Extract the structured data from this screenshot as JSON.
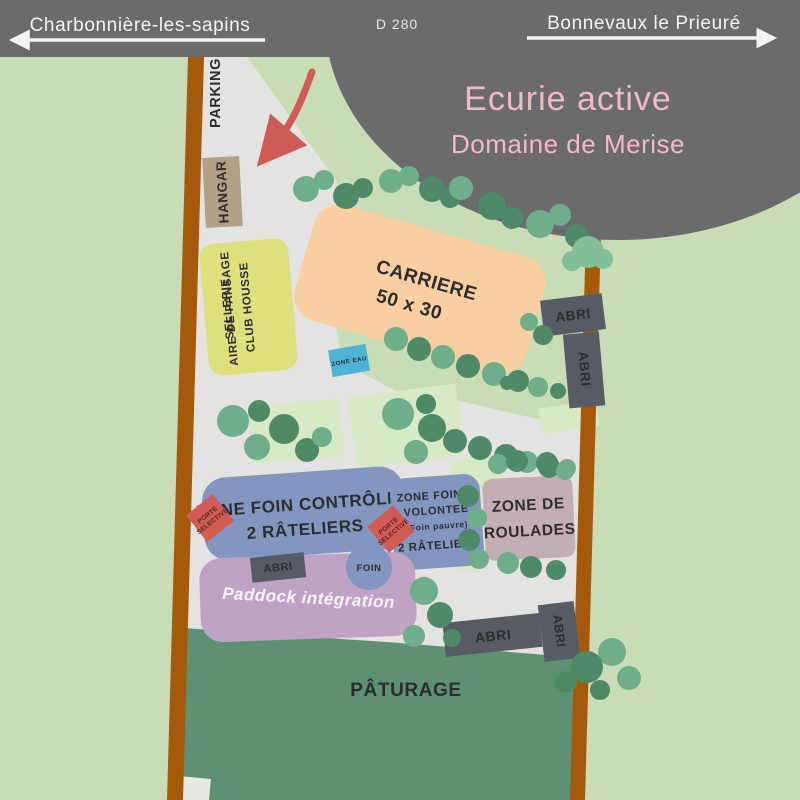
{
  "header": {
    "left_destination": "Charbonnière-les-sapins",
    "road_label": "D 280",
    "right_destination": "Bonnevaux le Prieuré"
  },
  "title": {
    "main": "Ecurie active",
    "subtitle": "Domaine de Merise"
  },
  "zones": {
    "parking": "PARKING",
    "hangar": "HANGAR",
    "sellerie_line1": "SELLERIE",
    "sellerie_line2": "CLUB HOUSSE",
    "sellerie_line3": "AIRE DE PANSAGE",
    "carriere_line1": "CARRIERE",
    "carriere_line2": "50 x 30",
    "zone_eau": "ZONE EAU",
    "abri": "ABRI",
    "foin_controlee_line1": "ZONE FOIN CONTRÔLEE",
    "foin_controlee_line2": "2 RÂTELIERS",
    "porte_selective_line1": "PORTE",
    "porte_selective_line2": "SELECTIVE",
    "foin_volonte_line1": "ZONE FOIN A",
    "foin_volonte_line2": "VOLONTEE",
    "foin_volonte_line3": "(Foin pauvre)",
    "foin_volonte_line4": "2 RÂTELIERS",
    "roulades_line1": "ZONE DE",
    "roulades_line2": "ROULADES",
    "foin": "FOIN",
    "paddock": "Paddock intégration",
    "paturage": "PÂTURAGE"
  },
  "colors": {
    "background_green": "#c8dcb6",
    "pale_green_patch": "#d8e9c6",
    "pasture_green": "#5e9173",
    "courtyard_gray": "#e4e3e1",
    "road_brown": "#a5590b",
    "header_gray": "#6b6a6c",
    "title_pink": "#f2bac6",
    "carriere_orange": "#f7cfa0",
    "sellerie_yellow": "#dee07b",
    "hangar_tan": "#b2a186",
    "water_blue": "#4eb3d7",
    "hay_zone_blue": "#8396bf",
    "roulades_mauve": "#c3aeb4",
    "paddock_purple": "#bfa2c4",
    "shelter_slate": "#565b64",
    "accent_red": "#cd5c55",
    "tree_light": "#6fae8a",
    "tree_dark": "#4f8a68",
    "tree_xlight": "#82bf9a",
    "label_dark": "#2d2d2f"
  }
}
